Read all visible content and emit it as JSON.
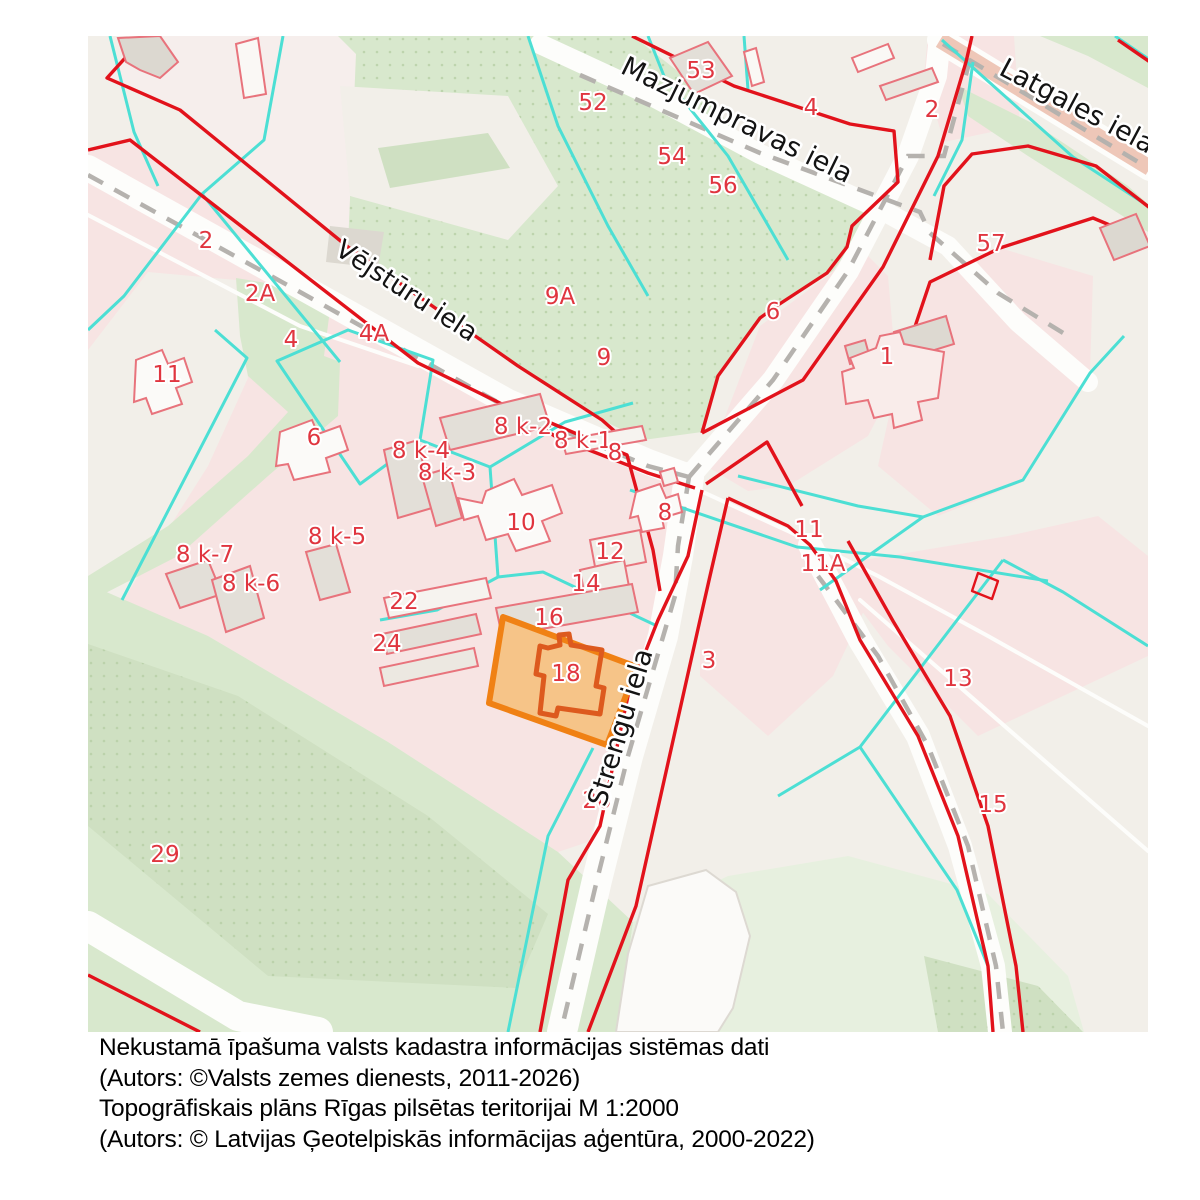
{
  "map": {
    "street_labels": [
      {
        "text": "Mazjumpravas iela",
        "x": 645,
        "y": 92,
        "rot": 26,
        "size": 27
      },
      {
        "text": "Vējstūru iela",
        "x": 314,
        "y": 262,
        "rot": 33,
        "size": 26
      },
      {
        "text": "Latgales iela",
        "x": 985,
        "y": 78,
        "rot": 28,
        "size": 27
      },
      {
        "text": "Strengu iela",
        "x": 541,
        "y": 694,
        "rot": -73,
        "size": 27
      }
    ],
    "parcel_labels": [
      {
        "text": "53",
        "x": 613,
        "y": 34
      },
      {
        "text": "52",
        "x": 505,
        "y": 66
      },
      {
        "text": "54",
        "x": 584,
        "y": 120
      },
      {
        "text": "56",
        "x": 635,
        "y": 149
      },
      {
        "text": "4",
        "x": 723,
        "y": 71
      },
      {
        "text": "2",
        "x": 844,
        "y": 73
      },
      {
        "text": "57",
        "x": 903,
        "y": 207
      },
      {
        "text": "2",
        "x": 118,
        "y": 204
      },
      {
        "text": "2A",
        "x": 172,
        "y": 257
      },
      {
        "text": "4",
        "x": 203,
        "y": 303
      },
      {
        "text": "4A",
        "x": 286,
        "y": 297
      },
      {
        "text": "11",
        "x": 79,
        "y": 338
      },
      {
        "text": "9A",
        "x": 472,
        "y": 260
      },
      {
        "text": "9",
        "x": 516,
        "y": 321
      },
      {
        "text": "6",
        "x": 685,
        "y": 275
      },
      {
        "text": "6",
        "x": 226,
        "y": 401
      },
      {
        "text": "1",
        "x": 799,
        "y": 320
      },
      {
        "text": "8 k-2",
        "x": 435,
        "y": 390
      },
      {
        "text": "8 k-1",
        "x": 495,
        "y": 404
      },
      {
        "text": "8",
        "x": 527,
        "y": 416
      },
      {
        "text": "8 k-4",
        "x": 333,
        "y": 414
      },
      {
        "text": "8 k-3",
        "x": 359,
        "y": 436
      },
      {
        "text": "8",
        "x": 577,
        "y": 476
      },
      {
        "text": "10",
        "x": 433,
        "y": 486
      },
      {
        "text": "11",
        "x": 721,
        "y": 493
      },
      {
        "text": "11A",
        "x": 735,
        "y": 527
      },
      {
        "text": "8 k-5",
        "x": 249,
        "y": 500
      },
      {
        "text": "8 k-7",
        "x": 117,
        "y": 518
      },
      {
        "text": "8 k-6",
        "x": 163,
        "y": 547
      },
      {
        "text": "12",
        "x": 522,
        "y": 515
      },
      {
        "text": "14",
        "x": 498,
        "y": 547
      },
      {
        "text": "16",
        "x": 461,
        "y": 581
      },
      {
        "text": "22",
        "x": 316,
        "y": 565
      },
      {
        "text": "24",
        "x": 299,
        "y": 607
      },
      {
        "text": "18",
        "x": 478,
        "y": 637
      },
      {
        "text": "3",
        "x": 621,
        "y": 624
      },
      {
        "text": "13",
        "x": 870,
        "y": 642
      },
      {
        "text": "20",
        "x": 509,
        "y": 764
      },
      {
        "text": "15",
        "x": 905,
        "y": 768
      },
      {
        "text": "29",
        "x": 77,
        "y": 818
      }
    ],
    "highlighted_parcel": "18"
  },
  "caption": {
    "line1": "Nekustamā īpašuma valsts kadastra informācijas sistēmas dati",
    "line2": "(Autors: ©Valsts zemes dienests, 2011-2026)",
    "line3": "Topogrāfiskais plāns Rīgas pilsētas teritorijai M 1:2000",
    "line4": "(Autors: © Latvijas Ģeotelpiskās informācijas aģentūra, 2000-2022)"
  },
  "colors": {
    "background": "#f2efe9",
    "parcel_pink": "#f7e4e3",
    "pale_pink": "#f6eeec",
    "green": "#d8e8cd",
    "pale_green": "#e7f0df",
    "cadastre_red": "#e2121b",
    "building_outline_red": "#e8737c",
    "topo_cyan": "#4cdfd4",
    "road_dash_gray": "#b5b2ae",
    "highlight_orange": "#f08114",
    "highlight_fill": "#f6c488",
    "label_red": "#e0353f",
    "latgales_band": "#eec7b8"
  }
}
